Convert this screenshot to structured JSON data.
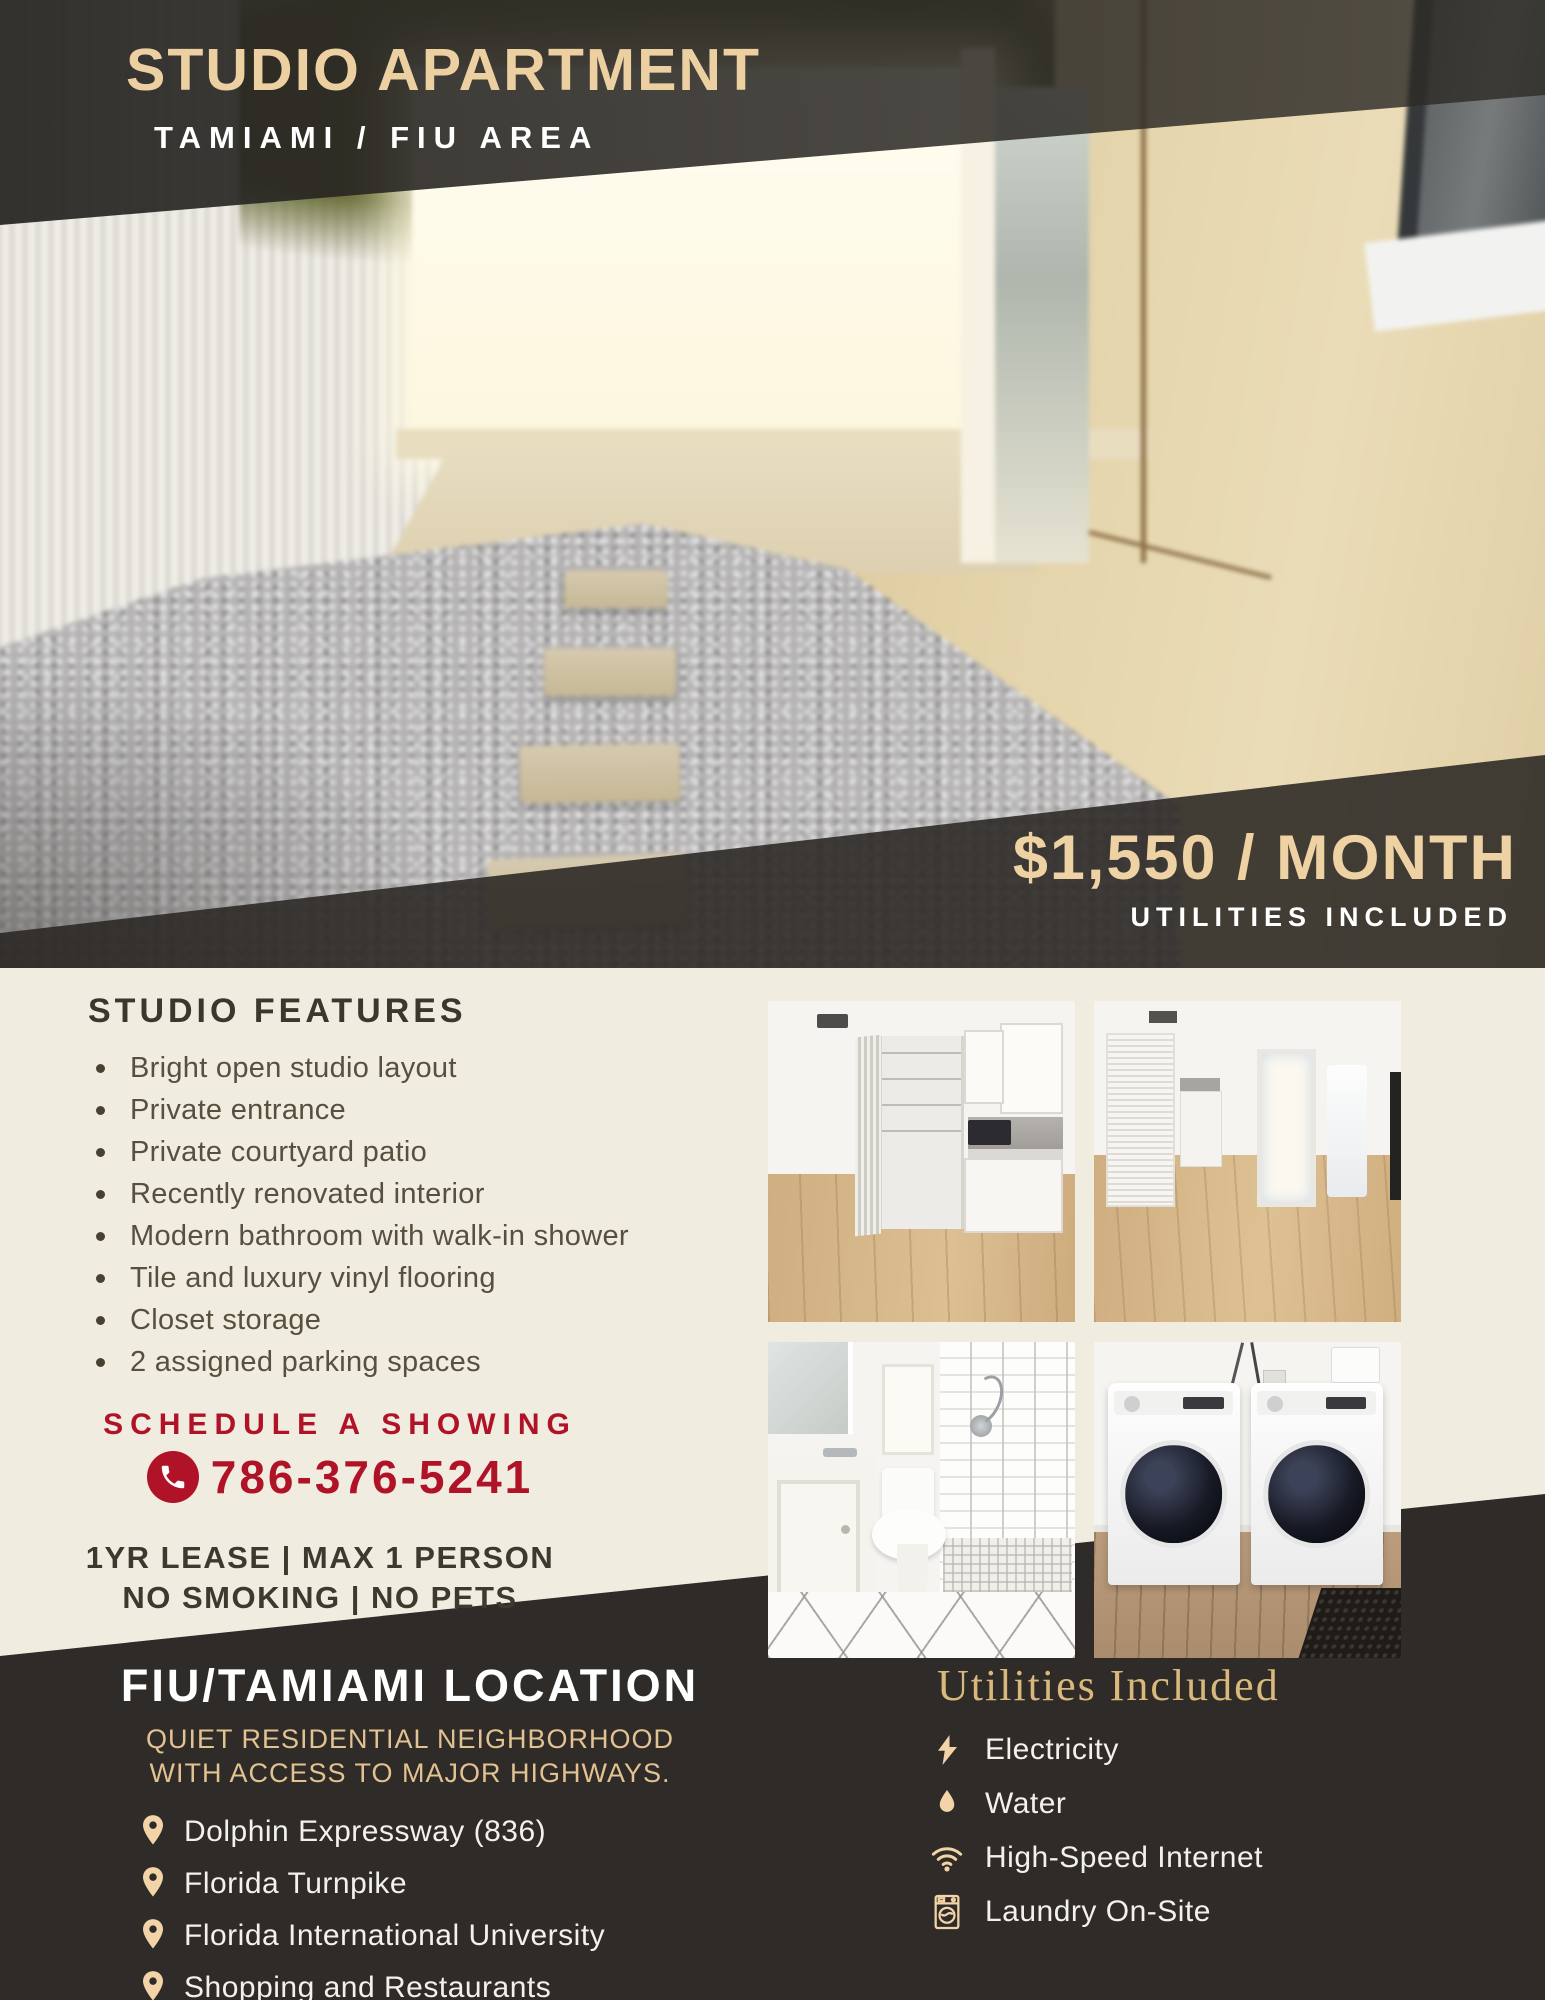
{
  "colors": {
    "accent_tan": "#ecd0a2",
    "accent_gold": "#e3c292",
    "accent_red": "#b01227",
    "dark": "#2e2b28",
    "cream": "#f1ece0"
  },
  "header": {
    "title": "STUDIO APARTMENT",
    "subtitle": "TAMIAMI / FIU AREA"
  },
  "price": {
    "amount": "$1,550 / MONTH",
    "note": "UTILITIES INCLUDED"
  },
  "features": {
    "heading": "STUDIO FEATURES",
    "items": [
      "Bright open studio layout",
      "Private entrance",
      "Private courtyard patio",
      "Recently renovated interior",
      "Modern bathroom with walk-in shower",
      "Tile and luxury vinyl flooring",
      "Closet storage",
      "2 assigned parking spaces"
    ]
  },
  "schedule": {
    "label": "SCHEDULE A SHOWING",
    "phone": "786-376-5241",
    "phone_icon": "phone-icon"
  },
  "terms": {
    "line1": "1YR LEASE | MAX 1 PERSON",
    "line2": "NO SMOKING | NO PETS"
  },
  "location": {
    "heading": "FIU/TAMIAMI LOCATION",
    "subheading": "QUIET RESIDENTIAL NEIGHBORHOOD WITH ACCESS TO MAJOR HIGHWAYS.",
    "pin_icon": "map-pin-icon",
    "items": [
      "Dolphin Expressway (836)",
      "Florida Turnpike",
      "Florida International University",
      "Shopping and Restaurants"
    ]
  },
  "utilities": {
    "heading": "Utilities Included",
    "items": [
      {
        "icon": "lightning-icon",
        "label": "Electricity"
      },
      {
        "icon": "water-drop-icon",
        "label": "Water"
      },
      {
        "icon": "wifi-icon",
        "label": "High-Speed Internet"
      },
      {
        "icon": "washing-machine-icon",
        "label": "Laundry On-Site"
      }
    ]
  }
}
